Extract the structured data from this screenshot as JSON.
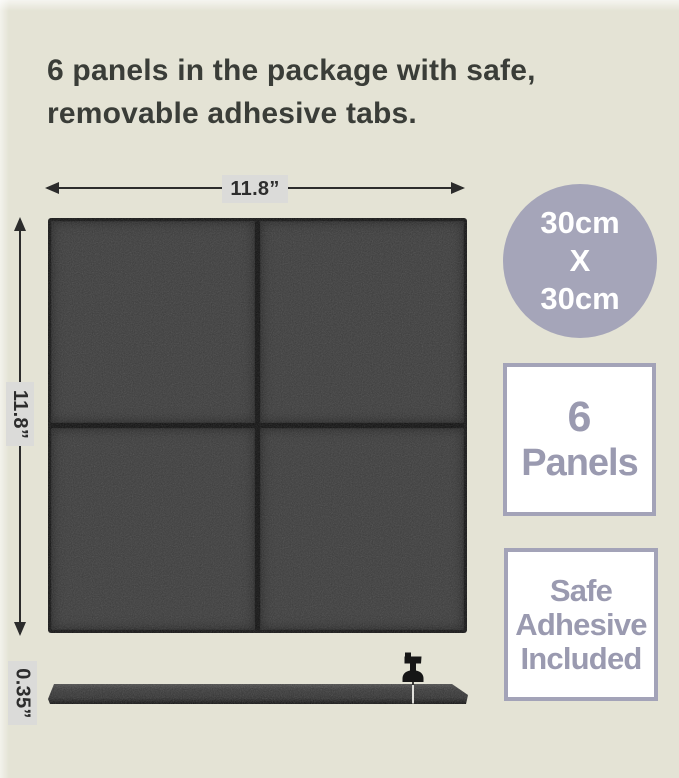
{
  "title": {
    "line1": "6 panels in the package with safe,",
    "line2": "removable adhesive tabs."
  },
  "dimensions": {
    "width": "11.8”",
    "height": "11.8”",
    "thickness": "0.35”"
  },
  "badges": {
    "size_circle": {
      "line1": "30cm",
      "line2": "X",
      "line3": "30cm"
    },
    "panels_box": {
      "line1": "6",
      "line2": "Panels"
    },
    "adhesive_box": {
      "line1": "Safe",
      "line2": "Adhesive",
      "line3": "Included"
    }
  },
  "colors": {
    "background": "#e4e3d5",
    "title_text": "#3a3d38",
    "arrow": "#2c2c2c",
    "dimension_label_bg": "#dbdbd9",
    "panel_felt": "#3b3b3b",
    "panel_edge": "#131313",
    "accent_lavender": "#a5a5b9",
    "badge_box_border": "#a3a3b8",
    "badge_box_text": "#9a9ab0",
    "badge_circle_text": "#ffffff"
  },
  "icons": {
    "push_pin": "push-pin",
    "arrows": "dimension-arrows"
  }
}
